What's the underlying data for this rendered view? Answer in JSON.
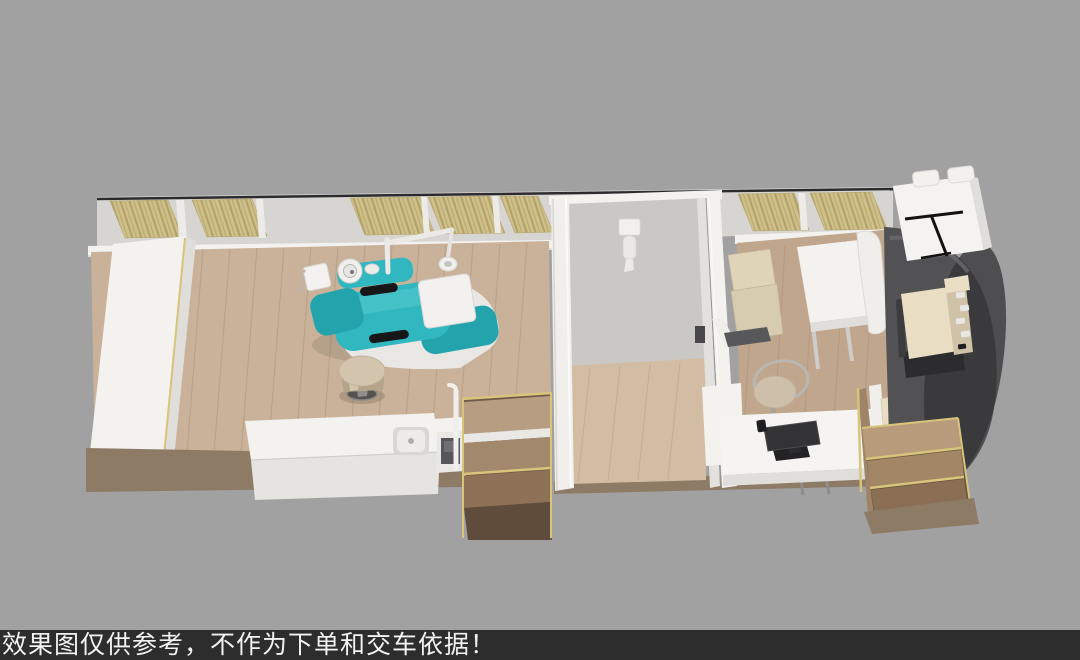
{
  "footer": {
    "caption": "效果图仅供参考，不作为下单和交车依据！"
  },
  "colors": {
    "bg": "#a1a1a1",
    "footerBg": "#2d2d2d",
    "footerText": "#f2f2f2",
    "white": "#f3f2ef",
    "whiteShade": "#e0deda",
    "wall": "#d6d5d2",
    "wallInner": "#c9c8c5",
    "glass": "#2b2b2e",
    "curtain": "#cfc08a",
    "curtainDark": "#b2a168",
    "wood": "#cab29a",
    "woodRight": "#c0a68c",
    "woodMid": "#d2bda4",
    "woodLine": "#9b8268",
    "base": "#8d7b66",
    "stepDark": "#6e5a49",
    "gold": "#d8c47a",
    "teal": "#31b7bf",
    "tealDark": "#23a4ad",
    "tealLight": "#57cdd2",
    "black": "#17171a",
    "cab": "#525254",
    "cabDark": "#333335",
    "cabLight": "#6b6b6d",
    "cream": "#e9ddc3",
    "creamDark": "#cfc2a6",
    "benchBeige": "#dfd3b8",
    "chrome": "#b9b7b2",
    "stool": "#cdbfa9",
    "screen": "#333335"
  }
}
